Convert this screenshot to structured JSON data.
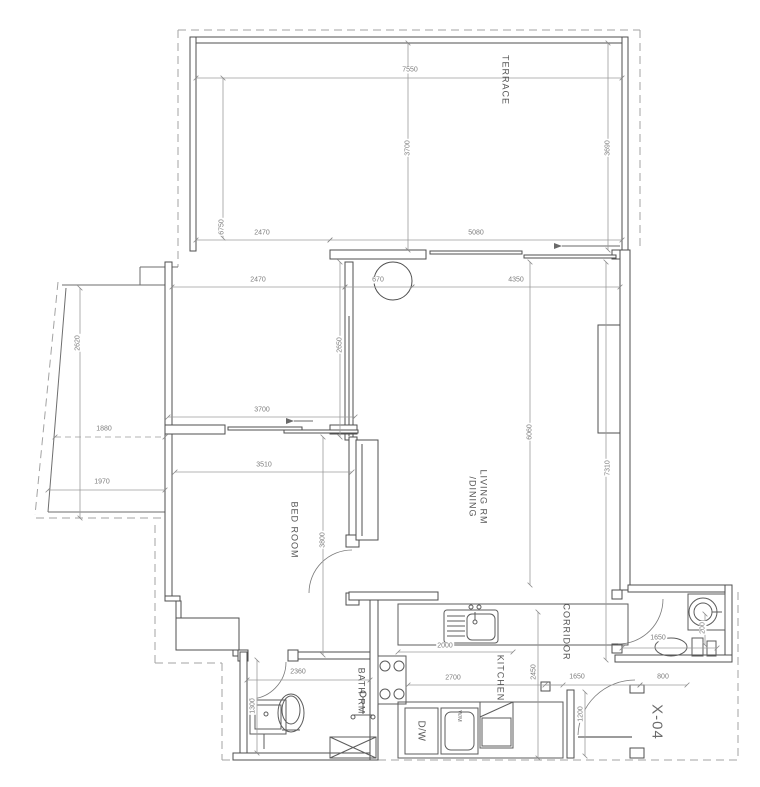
{
  "drawing": {
    "rooms": {
      "terrace": "TERRACE",
      "living_line1": "LIVING RM",
      "living_line2": "/DINING",
      "bedroom": "BED ROOM",
      "bathroom": "BATH RM",
      "kitchen": "KITCHEN",
      "corridor": "CORRIDOR"
    },
    "labels": {
      "unit_number": "X-04",
      "dishwasher": "D/W",
      "washer": "W/M"
    },
    "dimensions": {
      "terrace_width": "7550",
      "terrace_depth_mid": "3700",
      "terrace_depth_right": "3690",
      "terrace_depth_left": "6750",
      "terrace_seg_left": "2470",
      "terrace_seg_right": "5080",
      "court_width": "2470",
      "column_offset": "670",
      "living_width_top": "4350",
      "court_depth": "2620",
      "glass_wall": "2650",
      "bedroom_wall_top": "3700",
      "planter_width_mid": "1880",
      "planter_width_bottom": "1970",
      "bedroom_width": "3510",
      "bedroom_depth": "3800",
      "living_depth": "6060",
      "east_wall": "7310",
      "counter_length": "2000",
      "kitchen_width": "2700",
      "bathroom_width": "2360",
      "bathroom_depth": "1300",
      "corridor_depth": "2450",
      "corridor_width": "1650",
      "bath2_width": "1650",
      "entry_wall": "800",
      "entry_door": "1200",
      "basin_offset": "200"
    }
  }
}
